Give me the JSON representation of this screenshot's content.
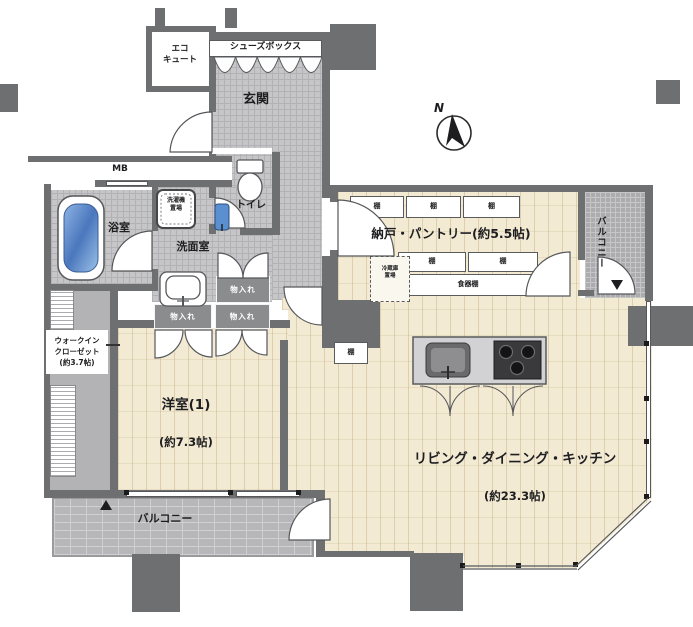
{
  "floorplan": {
    "compass": {
      "north_label": "N"
    },
    "rooms": {
      "entrance": {
        "label": "玄関"
      },
      "shoes_box": {
        "label": "シューズボックス"
      },
      "eco_cute": {
        "label": "エコ\nキュート"
      },
      "meter_box": {
        "label": "MB"
      },
      "bathroom": {
        "label": "浴室"
      },
      "washing_machine_area": {
        "label": "洗濯機\n置場"
      },
      "toilet": {
        "label": "トイレ"
      },
      "washroom": {
        "label": "洗面室"
      },
      "storage_label": "物入れ",
      "pantry": {
        "label": "納戸・パントリー(約5.5帖)",
        "shelf_label": "棚",
        "cupboard_label": "食器棚",
        "refrigerator_label": "冷蔵庫\n置場"
      },
      "walk_in_closet": {
        "label": "ウォークイン\nクローゼット\n(約3.7帖)"
      },
      "western_room": {
        "name": "洋室(1)",
        "size": "(約7.3帖)"
      },
      "ldk": {
        "name": "リビング・ダイニング・キッチン",
        "size": "(約23.3帖)"
      },
      "balcony_south": {
        "label": "バルコニー"
      },
      "balcony_east": {
        "label": "バルコニー"
      }
    },
    "markers": {
      "hatch_up": "▲",
      "hatch_down": "▼"
    },
    "colors": {
      "wall": "#6e6f71",
      "tile_floor": "#c6c5c7",
      "wood_floor": "#f3ead4",
      "balcony_floor": "#b7b7b9",
      "closet_fill": "#8b8c8e",
      "bathtub_blue": "#5a8fd0"
    }
  }
}
